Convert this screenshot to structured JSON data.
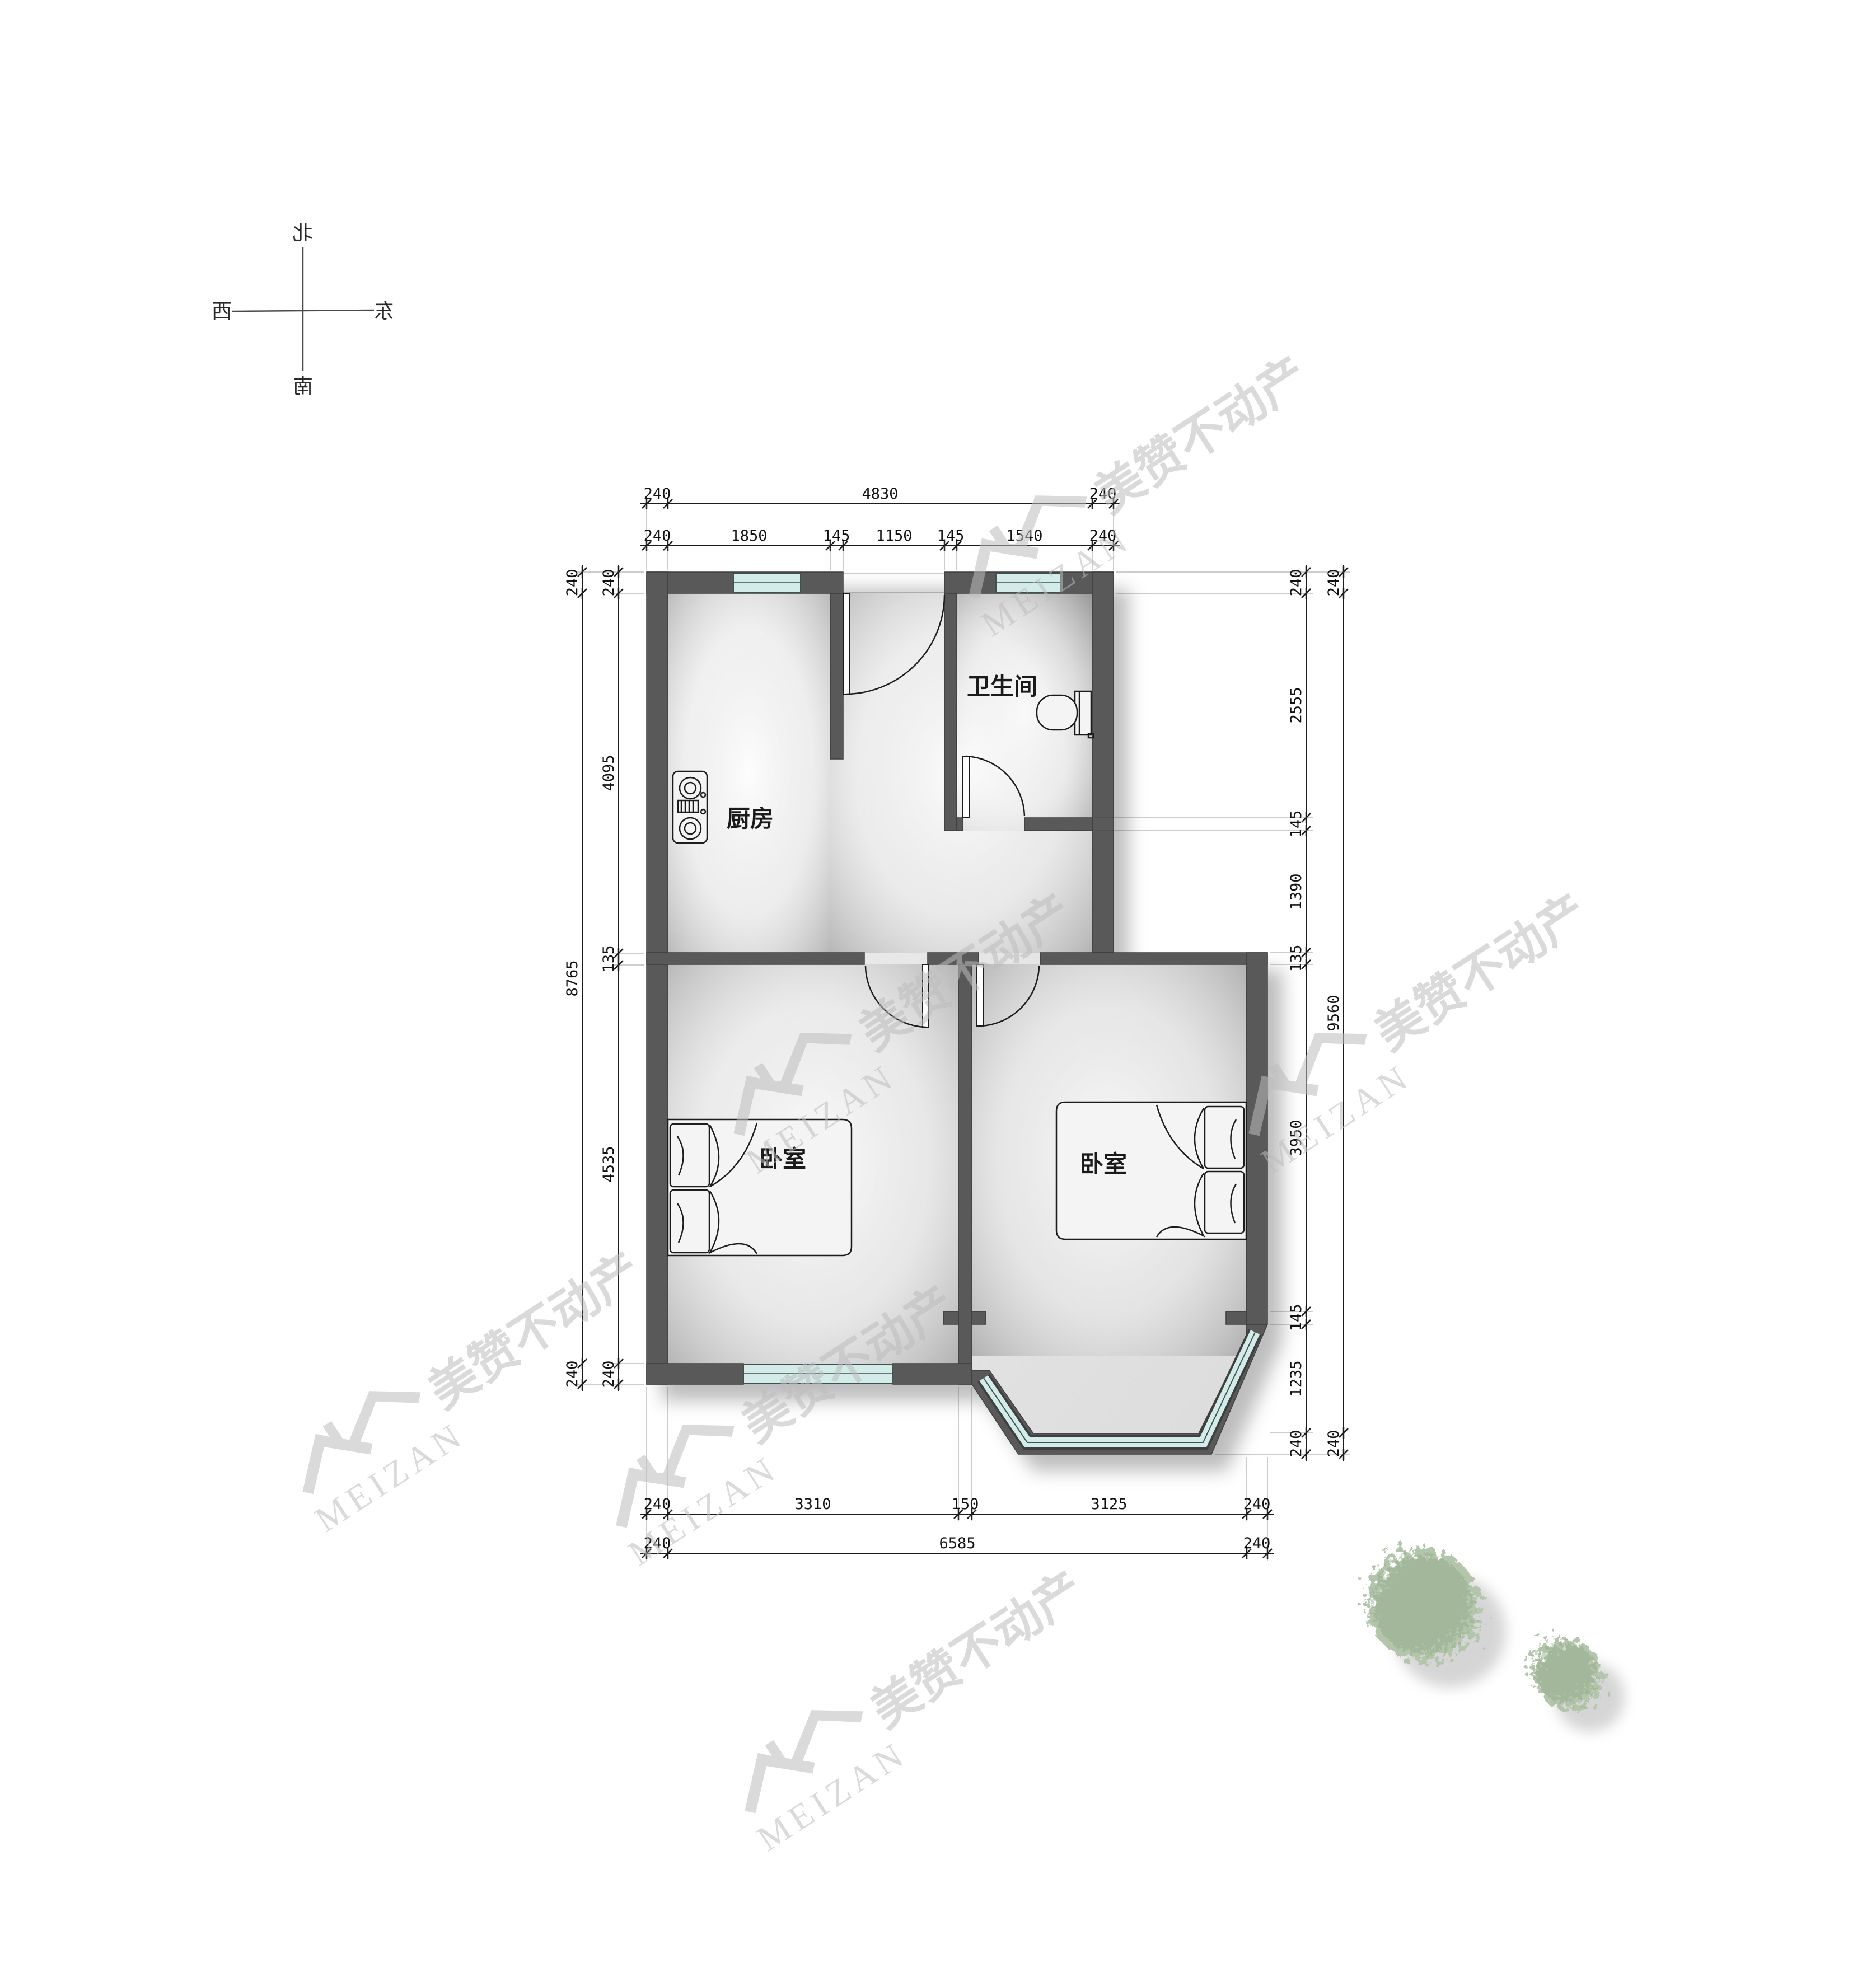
{
  "drawing": {
    "kind": "apartment floor plan",
    "compass": {
      "north": "北",
      "south": "南",
      "west": "西",
      "east": "东"
    },
    "watermark": {
      "brand": "MEIZAN",
      "cn": "美赞不动产"
    },
    "rooms": {
      "kitchen": "厨房",
      "bathroom": "卫生间",
      "bedroom_left": "卧室",
      "bedroom_right": "卧室"
    },
    "dims": {
      "top_outer": [
        "240",
        "4830",
        "240"
      ],
      "top_inner": [
        "240",
        "1850",
        "145",
        "1150",
        "145",
        "1540",
        "240"
      ],
      "left_outer": [
        "240",
        "8765",
        "240"
      ],
      "left_inner": [
        "240",
        "4095",
        "135",
        "4535",
        "240"
      ],
      "right_inner": [
        "240",
        "2555",
        "145",
        "1390",
        "135",
        "3950",
        "145",
        "1235",
        "240"
      ],
      "right_outer": [
        "240",
        "9560",
        "240"
      ],
      "bottom_inner": [
        "240",
        "3310",
        "150",
        "3125",
        "240"
      ],
      "bottom_outer": [
        "240",
        "6585",
        "240"
      ]
    },
    "icons": {
      "stove": "stove-icon",
      "toilet": "toilet-icon",
      "bed": "bed-icon",
      "window": "window-glass",
      "door": "door-swing-icon",
      "tree": "tree-icon",
      "compass": "compass-cross-icon"
    },
    "colors": {
      "wall": "#595959",
      "glass": "#d3ecea",
      "watermark": "#bdbdbd",
      "tree": "#b3c6ab",
      "dimension_text": "#111111",
      "background": "#ffffff"
    }
  }
}
